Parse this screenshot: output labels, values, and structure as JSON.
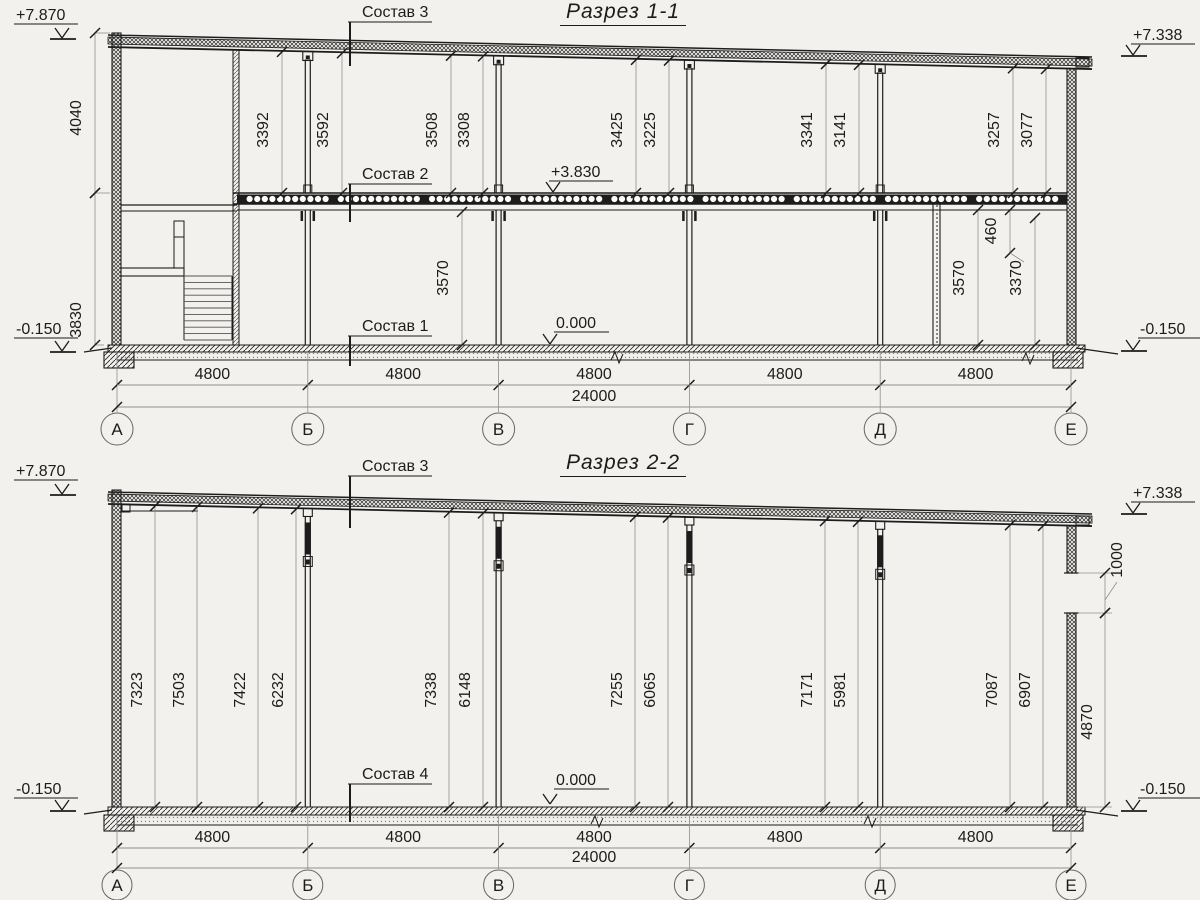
{
  "page": {
    "background": "#f2f1ee",
    "ink": "#1c1c1c",
    "thin": "#9a9a9a"
  },
  "axes": {
    "labels": [
      "А",
      "Б",
      "В",
      "Г",
      "Д",
      "Е"
    ],
    "bay_dims": [
      "4800",
      "4800",
      "4800",
      "4800",
      "4800"
    ],
    "total_dim": "24000"
  },
  "section1": {
    "title": "Разрез 1-1",
    "composition_labels": [
      "Состав 3",
      "Состав 2",
      "Состав 1"
    ],
    "elevations": {
      "roof_left": "+7.870",
      "roof_right": "+7.338",
      "floor2": "+3.830",
      "floor1": "0.000",
      "ground_left": "-0.150",
      "ground_right": "-0.150"
    },
    "left_dims": [
      "4040",
      "3830"
    ],
    "upper_floor_dims": [
      "3392",
      "3592",
      "3508",
      "3308",
      "3425",
      "3225",
      "3341",
      "3141",
      "3257",
      "3077"
    ],
    "ground_floor_dims": [
      "3570",
      "3570",
      "460",
      "3370"
    ]
  },
  "section2": {
    "title": "Разрез 2-2",
    "composition_labels": [
      "Состав 3",
      "Состав 4"
    ],
    "elevations": {
      "roof_left": "+7.870",
      "roof_right": "+7.338",
      "floor": "0.000",
      "ground_left": "-0.150",
      "ground_right": "-0.150"
    },
    "hall_dims": [
      "7323",
      "7503",
      "7422",
      "6232",
      "7338",
      "6148",
      "7255",
      "6065",
      "7171",
      "5981",
      "7087",
      "6907"
    ],
    "right_dims": [
      "1000",
      "4870"
    ]
  }
}
